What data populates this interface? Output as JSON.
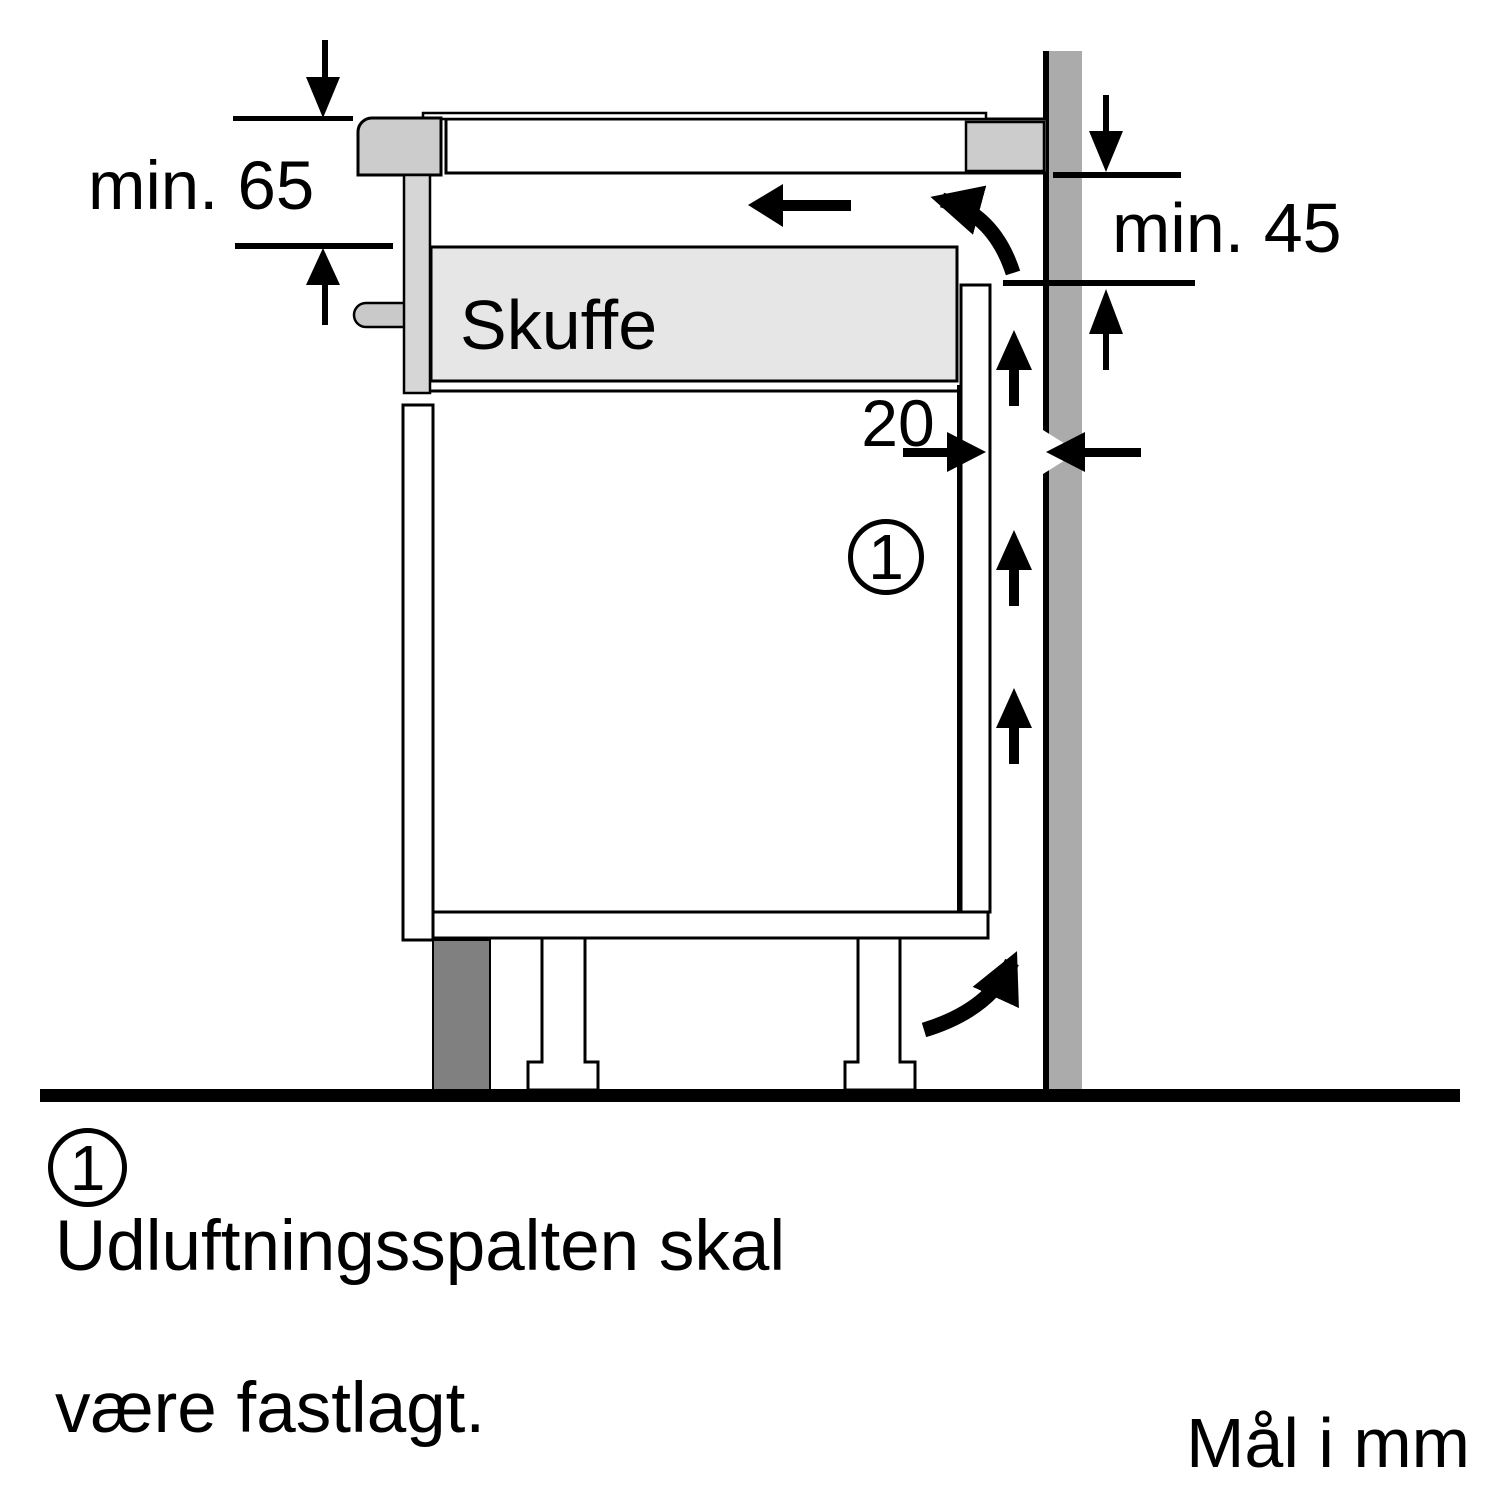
{
  "diagram": {
    "drawer_label": "Skuffe",
    "dimensions": {
      "hob_clearance": {
        "label": "min. 65"
      },
      "wall_clearance": {
        "label": "min. 45"
      },
      "vent_gap": {
        "label": "20"
      }
    },
    "callout_marker": "1"
  },
  "note": {
    "marker": "1",
    "line1": "Udluftningsspalten skal",
    "line2": "være fastlagt."
  },
  "footer": {
    "units_label": "Mål i mm"
  },
  "colors": {
    "outline": "#000000",
    "background": "#ffffff",
    "wall": "#ababab",
    "hob_edge": "#cccccc",
    "side_panel": "#d6d6d6",
    "handle": "#c9c9c9",
    "drawer_fill": "#e6e6e6",
    "plinth": "#808080"
  }
}
